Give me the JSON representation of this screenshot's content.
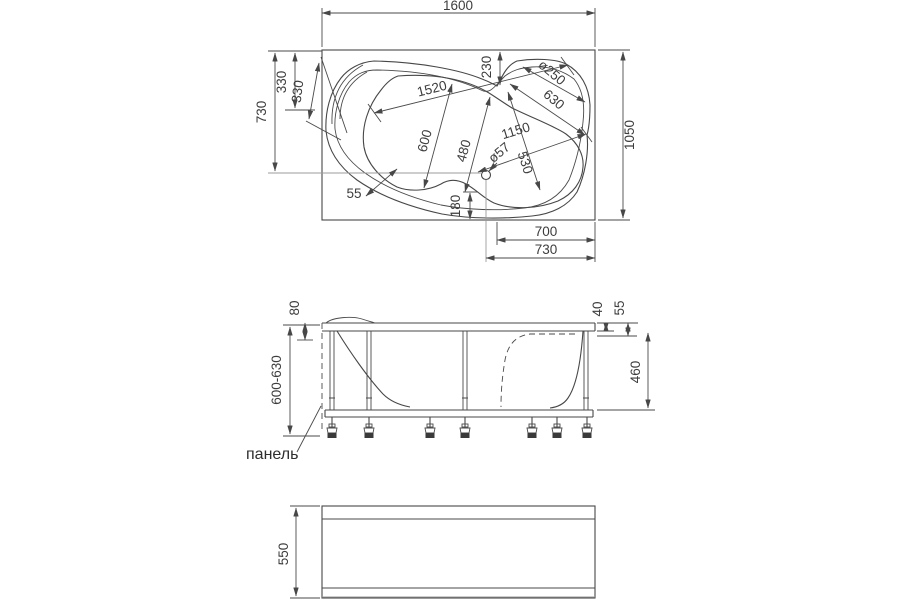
{
  "drawing_title": "corner bathtub technical drawing, three orthographic views",
  "colors": {
    "line": "#474747",
    "aux": "#9b9b9b",
    "background": "#ffffff",
    "foot": "#3a3a3a"
  },
  "plan_view": {
    "dims": {
      "overall_length": "1600",
      "overall_width": "1050",
      "left_depth": "730",
      "left_edge_inner": "330",
      "headrest_width": "330",
      "bowl_length": "1520",
      "corner_offset": "230",
      "corner_radius": "ø250",
      "corner_diagonal": "630",
      "inner_length": "1150",
      "bowl_width_1": "600",
      "bowl_width_2": "480",
      "bowl_width_3": "530",
      "drain_diameter": "ø57",
      "rim_width": "55",
      "drain_to_edge": "180",
      "bottom_inner": "700",
      "bottom_outer": "730"
    }
  },
  "side_view": {
    "dims": {
      "rim_drop": "80",
      "rim_thickness": "40",
      "apron_step": "55",
      "frame_height": "460",
      "adjustable_height": "600-630"
    },
    "panel_label": "панель"
  },
  "front_panel_view": {
    "dims": {
      "panel_height": "550"
    }
  }
}
